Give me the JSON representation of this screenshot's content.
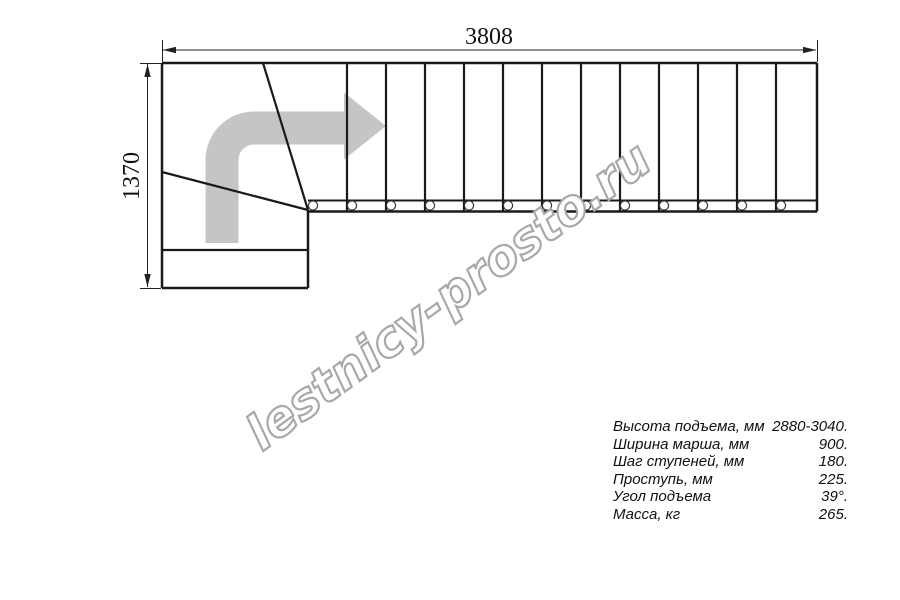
{
  "plan": {
    "top_dimension_label": "3808",
    "left_dimension_label": "1370",
    "straight_step_count": 13,
    "winder_step_count": 3,
    "support_circle_count": 13,
    "direction_arrow": "turn-right-then-straight"
  },
  "watermark": {
    "text": "lestnicy-prosto.ru"
  },
  "specs": {
    "rows": [
      {
        "label": "Высота подъема, мм",
        "value": "2880-3040."
      },
      {
        "label": "Ширина марша, мм",
        "value": "900."
      },
      {
        "label": "Шаг ступеней, мм",
        "value": "180."
      },
      {
        "label": "Проступь, мм",
        "value": "225."
      },
      {
        "label": "Угол подъема",
        "value": "39°."
      },
      {
        "label": "Масса, кг",
        "value": "265."
      }
    ]
  },
  "colors": {
    "line": "#1a1a1a",
    "thin_line": "#222222",
    "arrow_gray": "#c5c5c5",
    "watermark_outline": "#a8a8a8",
    "background": "#ffffff"
  }
}
